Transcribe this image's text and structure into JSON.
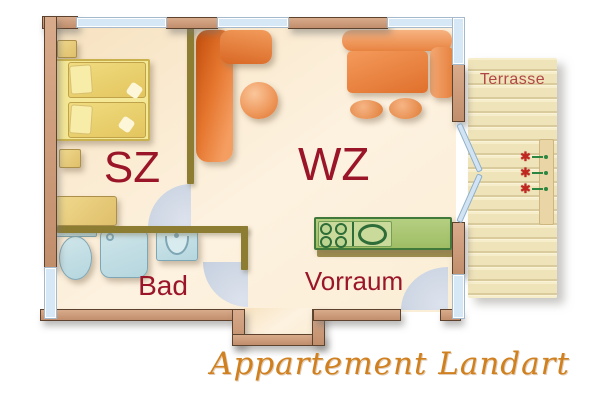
{
  "plan": {
    "caption": "Appartement Landart",
    "rooms": {
      "bedroom": {
        "label": "SZ"
      },
      "living": {
        "label": "WZ"
      },
      "bath": {
        "label": "Bad"
      },
      "hall": {
        "label": "Vorraum"
      },
      "terrace": {
        "label": "Terrasse"
      }
    },
    "terrace": {
      "flower_count": 3
    },
    "kitchen": {
      "burner_count": 4
    },
    "colors": {
      "room_label": "#9b1528",
      "terrace_label": "#b04646",
      "caption_orange": "#d0801e",
      "wall_tan": "#cb9b7e",
      "interior_wall_olive": "#8d7d33",
      "window_blue": "#d6e7f5",
      "sofa_orange": "#e87d3c",
      "bed_yellow": "#ead168",
      "kitchen_green": "#a9c573",
      "bath_fixture_blue": "#c4e0e6",
      "floor_cream": "#f9e9cd",
      "terrace_plank": "#f3e9c6",
      "flower_red": "#c2271f",
      "plant_green": "#2c8640",
      "door_arc_blue": "#c9d3e2"
    }
  }
}
